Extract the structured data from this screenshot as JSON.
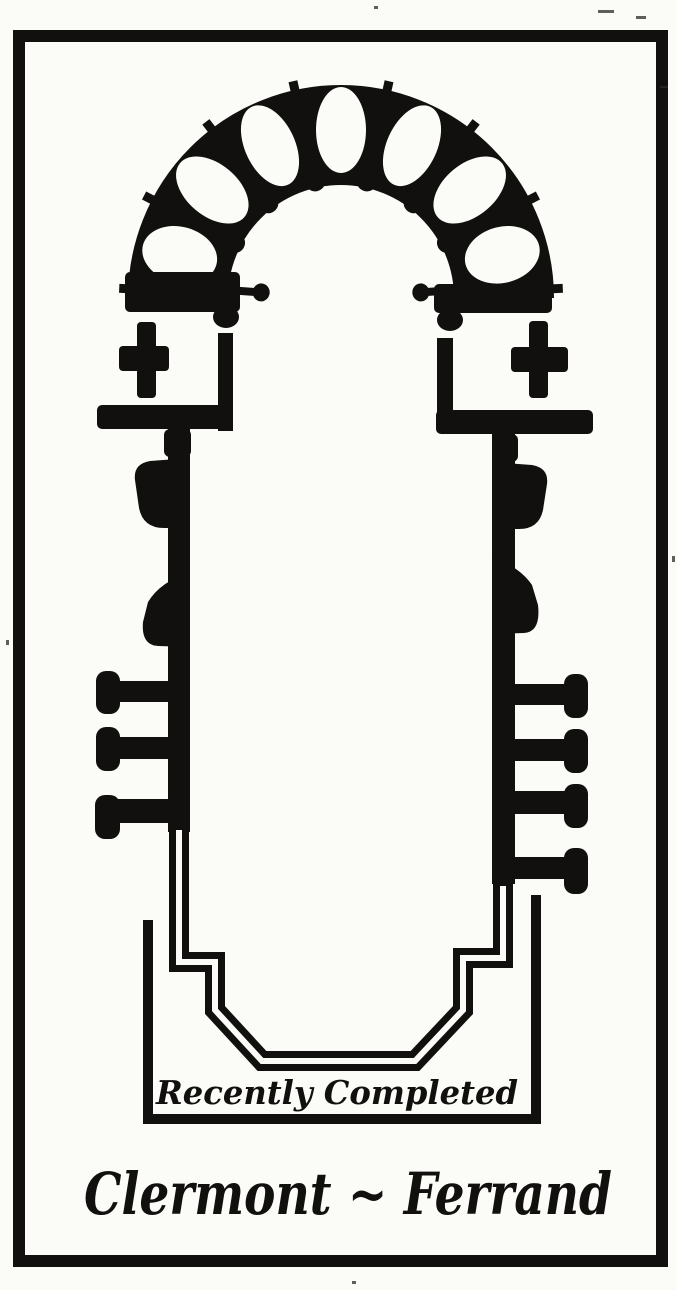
{
  "figure": {
    "annotation": "Recently Completed",
    "caption": "Clermont ~ Ferrand"
  },
  "colors": {
    "ink": "#11100e",
    "paper": "#fbfbf8"
  },
  "plan_facts": {
    "depicts": "cathedral ground plan",
    "radiating_chapels": 7,
    "ambulatory_columns": 8,
    "transept_crosses": 2,
    "buttress_piers_left": 3,
    "buttress_piers_right": 4
  }
}
